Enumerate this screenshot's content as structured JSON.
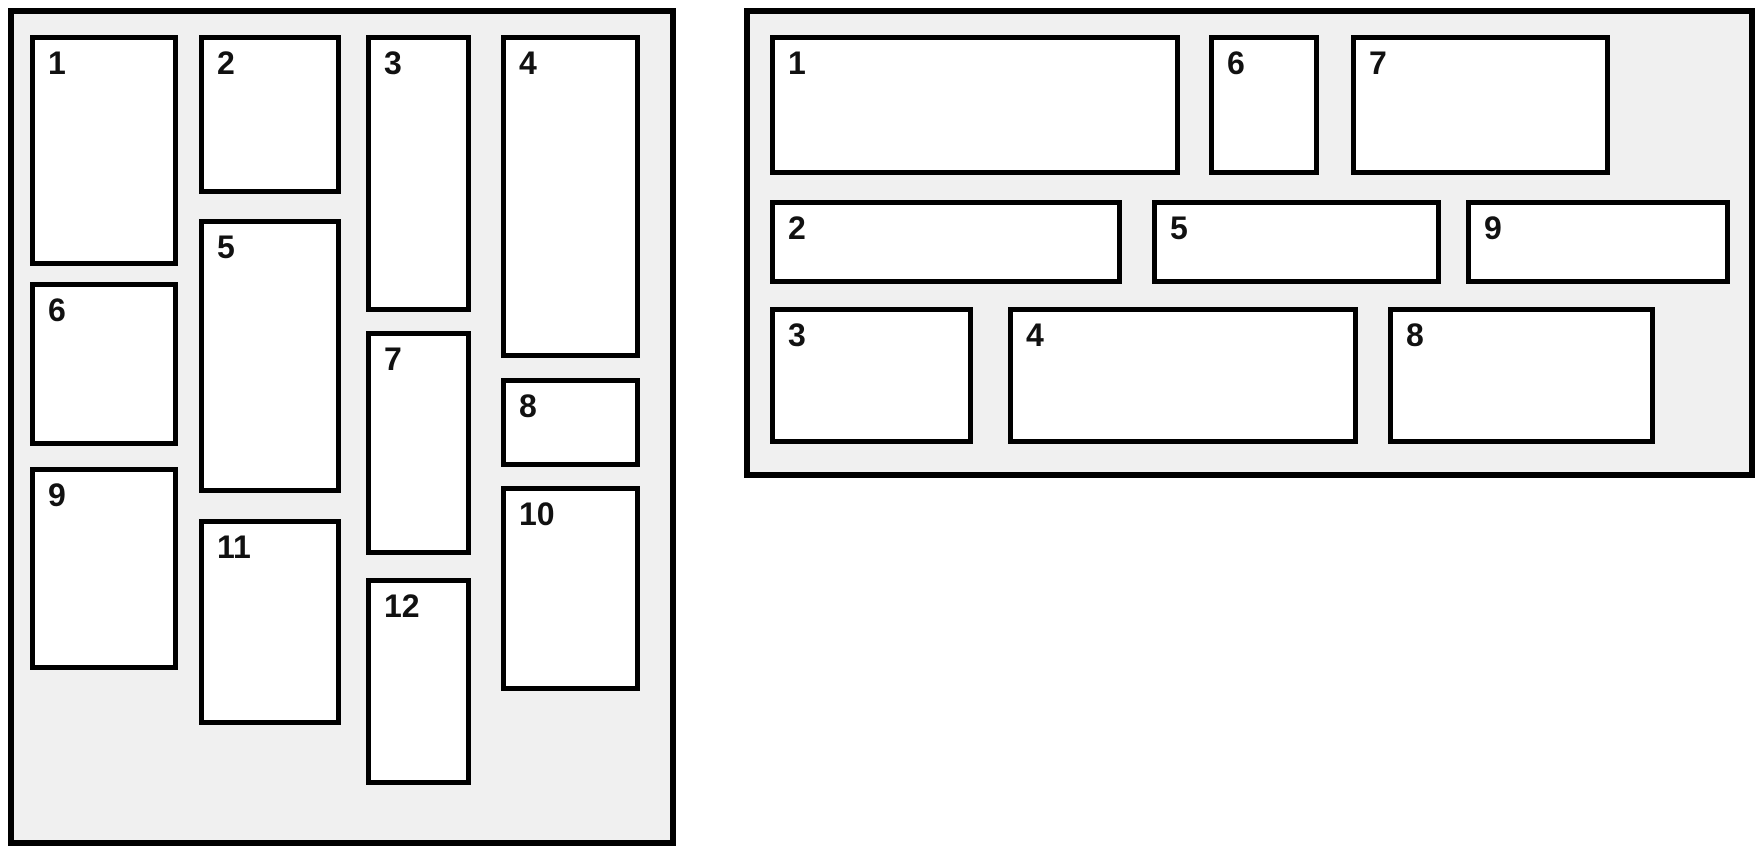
{
  "canvas": {
    "width": 1755,
    "height": 852,
    "background": "#ffffff"
  },
  "colors": {
    "panel_background": "#f0f0f0",
    "card_background": "#ffffff",
    "border": "#000000",
    "label_text": "#111111"
  },
  "panels": [
    {
      "id": "masonry-columns",
      "description": "Masonry layout panel with items flowing in vertical columns",
      "x": 8,
      "y": 8,
      "width": 668,
      "height": 838,
      "cards": [
        {
          "label": "1",
          "x": 16,
          "y": 21,
          "w": 148,
          "h": 231
        },
        {
          "label": "2",
          "x": 185,
          "y": 21,
          "w": 142,
          "h": 159
        },
        {
          "label": "3",
          "x": 352,
          "y": 21,
          "w": 105,
          "h": 277
        },
        {
          "label": "4",
          "x": 487,
          "y": 21,
          "w": 139,
          "h": 323
        },
        {
          "label": "5",
          "x": 185,
          "y": 205,
          "w": 142,
          "h": 274
        },
        {
          "label": "6",
          "x": 16,
          "y": 268,
          "w": 148,
          "h": 164
        },
        {
          "label": "7",
          "x": 352,
          "y": 317,
          "w": 105,
          "h": 224
        },
        {
          "label": "8",
          "x": 487,
          "y": 364,
          "w": 139,
          "h": 89
        },
        {
          "label": "9",
          "x": 16,
          "y": 453,
          "w": 148,
          "h": 203
        },
        {
          "label": "10",
          "x": 487,
          "y": 472,
          "w": 139,
          "h": 205
        },
        {
          "label": "11",
          "x": 185,
          "y": 505,
          "w": 142,
          "h": 206
        },
        {
          "label": "12",
          "x": 352,
          "y": 564,
          "w": 105,
          "h": 207
        }
      ]
    },
    {
      "id": "masonry-rows",
      "description": "Masonry layout panel with items flowing in horizontal rows",
      "x": 744,
      "y": 8,
      "width": 1011,
      "height": 470,
      "cards": [
        {
          "label": "1",
          "x": 20,
          "y": 21,
          "w": 410,
          "h": 140
        },
        {
          "label": "2",
          "x": 20,
          "y": 186,
          "w": 352,
          "h": 84
        },
        {
          "label": "3",
          "x": 20,
          "y": 293,
          "w": 203,
          "h": 137
        },
        {
          "label": "4",
          "x": 258,
          "y": 293,
          "w": 350,
          "h": 137
        },
        {
          "label": "5",
          "x": 402,
          "y": 186,
          "w": 289,
          "h": 84
        },
        {
          "label": "6",
          "x": 459,
          "y": 21,
          "w": 110,
          "h": 140
        },
        {
          "label": "7",
          "x": 601,
          "y": 21,
          "w": 259,
          "h": 140
        },
        {
          "label": "8",
          "x": 638,
          "y": 293,
          "w": 267,
          "h": 137
        },
        {
          "label": "9",
          "x": 716,
          "y": 186,
          "w": 264,
          "h": 84
        }
      ]
    }
  ]
}
